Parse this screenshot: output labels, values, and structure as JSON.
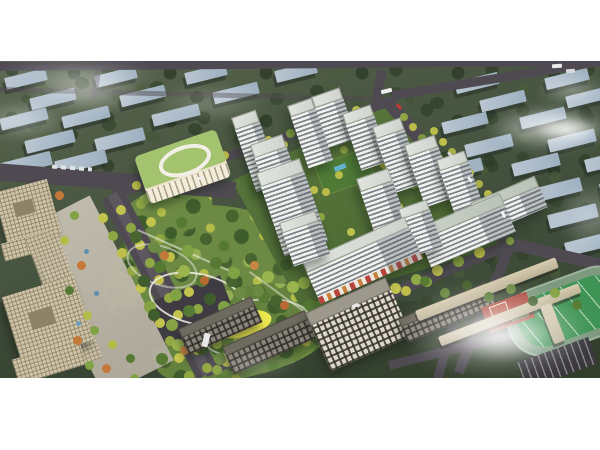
{
  "scene": {
    "type": "architectural-aerial-rendering",
    "description": "Oblique aerial masterplan rendering of a residential compound: white high-rise apartment towers with striped window bands arranged around landscaped green courtyards, a large central park with winding white paths and a bright yellow playground, a kindergarten with an oval green roof, tan office towers and a plaza on the west, tree-lined boulevards with yellow-green trees, a school campus with running track, football pitch and red basketball courts to the southeast, rows of existing slab buildings fading into dark greenery to the north and east, and soft white clouds drifting over the scene. White margins frame the rendering top and bottom."
  },
  "labels": {
    "rendering": "Aerial masterplan rendering",
    "background_city": "Rows of existing apartment blocks in greenery",
    "roads": "Urban road network",
    "street_trees": "Street trees along roads",
    "offices": "Office towers and plaza",
    "kindergarten": "Kindergarten with oval rooftop",
    "park": "Central landscaped park",
    "park_paths": "Winding white park paths",
    "playground": "Yellow children's playground",
    "courtyard": "Residential courtyard landscaping",
    "towers": "White residential high-rise towers",
    "retail_slab": "Mixed-use slab with street-level retail",
    "city_south": "Existing mid-rise city blocks",
    "school": "School campus",
    "sports_field": "Running track and football pitch",
    "basketball_courts": "Basketball courts",
    "parking": "Parking lot",
    "vehicles": "Cars and buses on roads",
    "clouds": "Clouds and fog"
  },
  "palette": {
    "page-bg": "#ffffff",
    "ground": "#4a5542",
    "ground-dark": "#39462f",
    "road": "#4f4a52",
    "bg-roof": "#bac6d2",
    "bg-face": "#53604e",
    "tower-face": "#f2f3ef",
    "tower-stripe": "#7e868c",
    "tower-roof": "#cfd3cd",
    "park-base": "#6c8a43",
    "park-dark": "#47632f",
    "park-light": "#95b054",
    "tree-yellow": "#bcbf4a",
    "tree-orange": "#c4793a",
    "path-white": "#eceade",
    "playground-yellow": "#ece74e",
    "kg-roof": "#a3c36e",
    "kg-body": "#ece3cc",
    "office-tan": "#cec3a6",
    "city-face": "#ddd8c8",
    "field-green": "#3f9355",
    "track-ring": "#7d9a7f",
    "court-red": "#ad4a3c",
    "cloud": "#ffffff"
  }
}
